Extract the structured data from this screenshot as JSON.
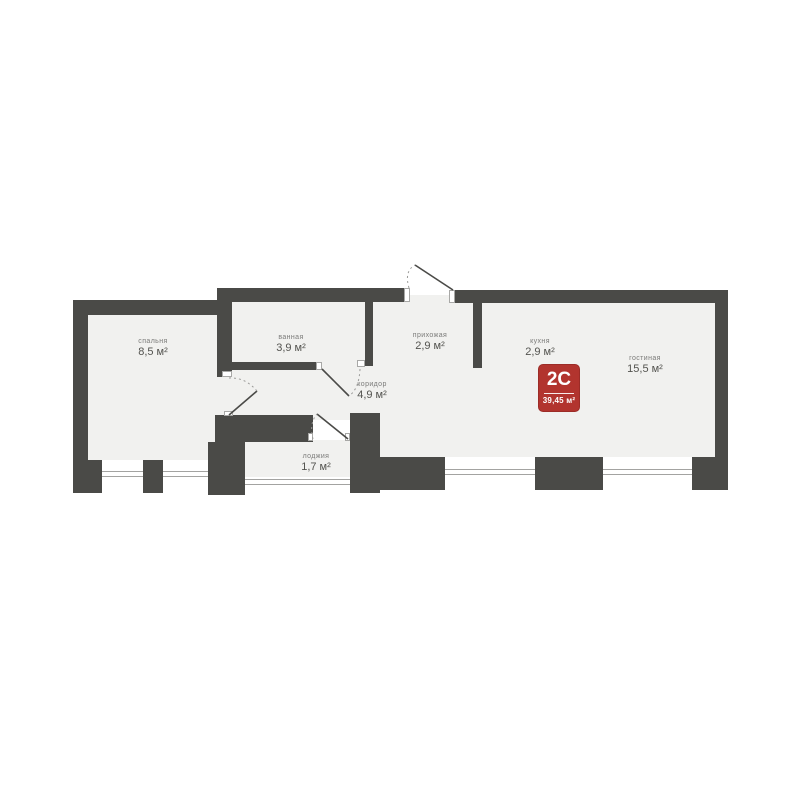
{
  "plan": {
    "rooms": [
      {
        "id": "bedroom",
        "name": "спальня",
        "area": "8,5 м²"
      },
      {
        "id": "bathroom",
        "name": "ванная",
        "area": "3,9 м²"
      },
      {
        "id": "hallway",
        "name": "прихожая",
        "area": "2,9 м²"
      },
      {
        "id": "corridor",
        "name": "коридор",
        "area": "4,9 м²"
      },
      {
        "id": "kitchen",
        "name": "кухня",
        "area": "2,9 м²"
      },
      {
        "id": "living_room",
        "name": "гостиная",
        "area": "15,5 м²"
      },
      {
        "id": "loggia",
        "name": "лоджия",
        "area": "1,7 м²"
      }
    ],
    "badge": {
      "type": "2С",
      "total_area": "39,45 м²"
    },
    "colors": {
      "wall": "#4a4a47",
      "floor": "#f1f1ef",
      "badge": "#b2342e",
      "badge_border": "#9c2c27",
      "glazing_line": "#a3a3a1",
      "background": "#ffffff"
    }
  }
}
